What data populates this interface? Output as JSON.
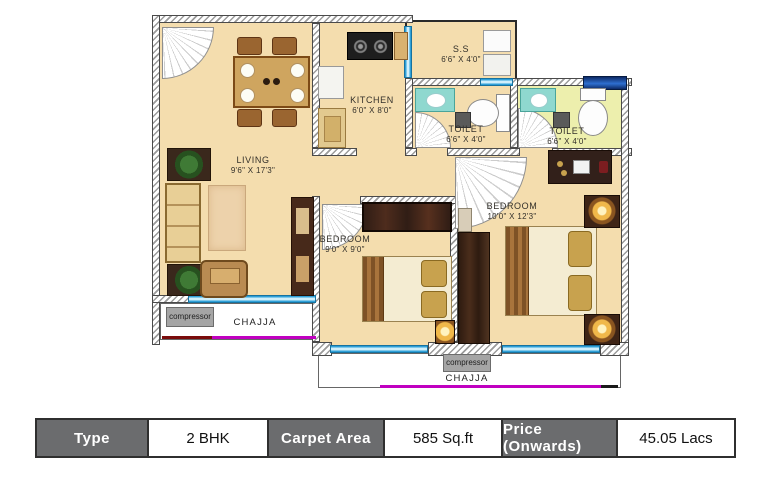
{
  "rooms": {
    "living": {
      "name": "LIVING",
      "dims": "9'6\" X 17'3\""
    },
    "kitchen": {
      "name": "KITCHEN",
      "dims": "6'0\" X 8'0\""
    },
    "ss": {
      "name": "S.S",
      "dims": "6'6\" X 4'0\""
    },
    "toilet1": {
      "name": "TOILET",
      "dims": "6'6\" X 4'0\""
    },
    "toilet2": {
      "name": "TOILET",
      "dims": "6'6\" X 4'0\""
    },
    "bedroom_small": {
      "name": "BEDROOM",
      "dims": "9'0\" X 9'0\""
    },
    "bedroom_master": {
      "name": "BEDROOM",
      "dims": "10'0\" X 12'3\""
    }
  },
  "balconies": {
    "chajja_left": {
      "label": "CHAJJA",
      "compressor_label": "compressor"
    },
    "chajja_bottom": {
      "label": "CHAJJA",
      "compressor_label": "compressor"
    }
  },
  "spec_table": {
    "type_label": "Type",
    "type_value": "2 BHK",
    "area_label": "Carpet  Area",
    "area_value": "585 Sq.ft",
    "price_label": "Price (Onwards)",
    "price_value": "45.05 Lacs"
  },
  "colors": {
    "floor": "#f4ddae",
    "toilet_floor": "#edefad",
    "wall_hatch": "#9b9b9b",
    "window_cyan": "#2fa0d8",
    "window_navy": "#16418f",
    "chajja_line_magenta": "#c000c0",
    "table_header_bg": "#6b6c6e"
  }
}
